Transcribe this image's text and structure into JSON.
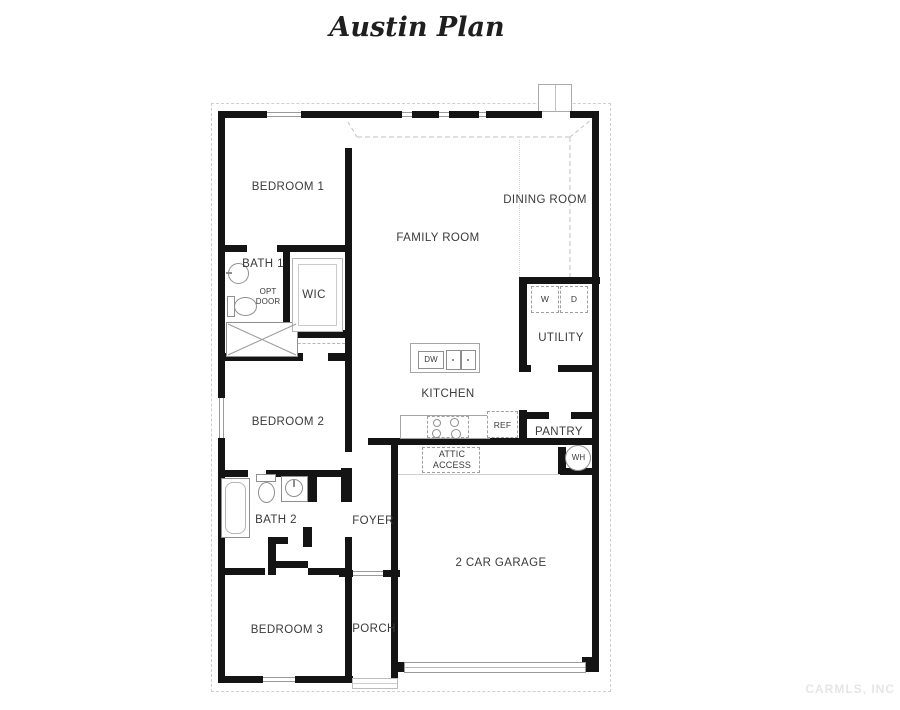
{
  "title": "Austin Plan",
  "watermark": "CARMLS, INC",
  "rooms": {
    "bedroom1": "BEDROOM 1",
    "dining_room": "DINING ROOM",
    "family_room": "FAMILY ROOM",
    "bath1": "BATH 1",
    "opt_door": "OPT DOOR",
    "wic": "WIC",
    "utility": "UTILITY",
    "kitchen": "KITCHEN",
    "bedroom2": "BEDROOM 2",
    "pantry": "PANTRY",
    "attic_access": "ATTIC ACCESS",
    "bath2": "BATH 2",
    "foyer": "FOYER",
    "garage": "2 CAR GARAGE",
    "bedroom3": "BEDROOM 3",
    "porch": "PORCH"
  },
  "appliances": {
    "dw": "DW",
    "ref": "REF",
    "washer": "W",
    "dryer": "D",
    "water_heater": "WH"
  },
  "colors": {
    "wall": "#141414",
    "fixture_line": "#8f8f8f",
    "dashed_line": "#c0c0c0",
    "label": "#3a3a3a",
    "watermark": "#e6e6e6",
    "background": "#ffffff"
  }
}
